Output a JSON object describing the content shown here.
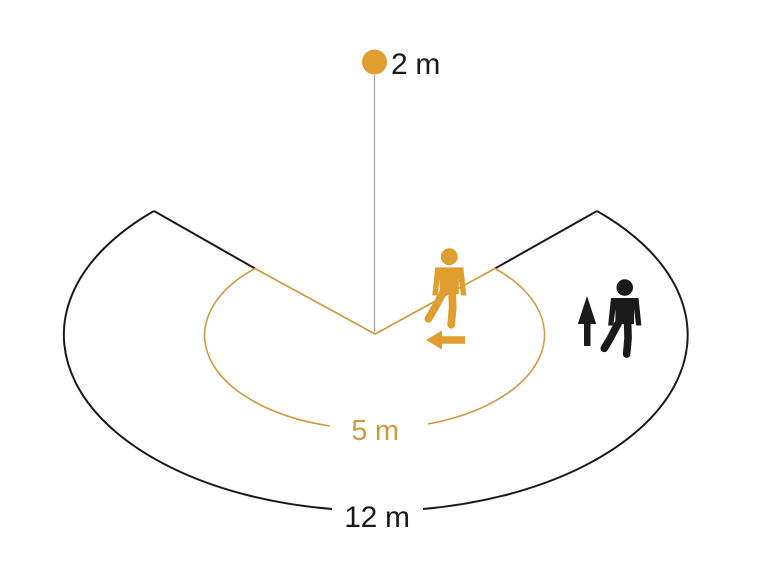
{
  "diagram": {
    "labels": {
      "mounting_height": "2 m",
      "inner_radius": "5 m",
      "outer_radius": "12 m"
    },
    "icons": {
      "sensor_dot": "filled-circle",
      "tangential_person": "walking-person",
      "tangential_direction": "left-arrow",
      "radial_person": "walking-person",
      "radial_direction": "up-arrow"
    },
    "colors": {
      "accent_orange": "#DF9E2F",
      "accent_orange_line": "#CC9C45",
      "ink_black": "#1A1A1A",
      "gray_line": "#A9A9A9",
      "background": "#FFFFFF"
    }
  }
}
